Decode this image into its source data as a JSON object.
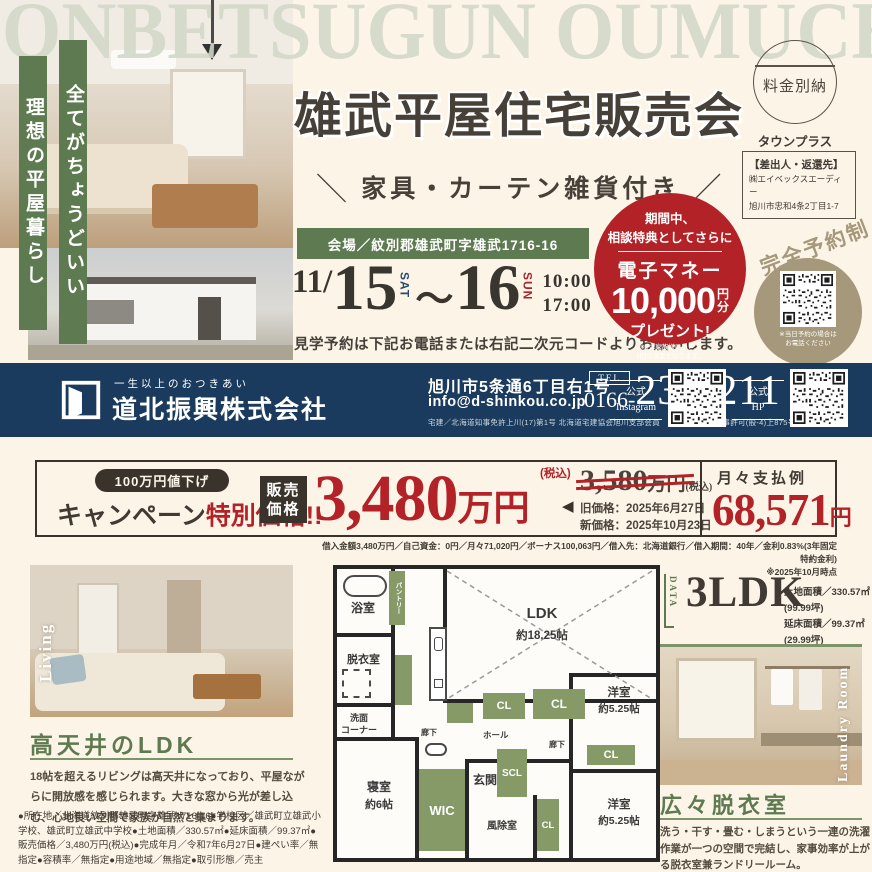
{
  "watermark": "ONBETSUGUN OUMUCHO",
  "top": {
    "banner_left": "理想の平屋暮らし",
    "banner_right": "全てがちょうどいい",
    "title": "雄武平屋住宅販売会",
    "subtitle_left_slash": "＼",
    "subtitle": "家具・カーテン雑貨付き",
    "subtitle_right_slash": "／",
    "postal_stamp": "料金別納",
    "postal_service": "タウンプラス",
    "sender_heading": "【差出人・返還先】",
    "sender_name": "㈱エイベックスエーディー",
    "sender_address": "旭川市忠和4条2丁目1-7",
    "venue": "会場／紋別郡雄武町字雄武1716-16",
    "date_month": "11/",
    "date_day1": "15",
    "date_day1_dow": "SAT",
    "date_tilde": "～",
    "date_day2": "16",
    "date_day2_dow": "SUN",
    "time_line1": "10:00 -",
    "time_line2": "17:00",
    "booking_note": "見学予約は下記お電話または右記二次元コードよりお願いします。",
    "bonus": {
      "line1": "期間中、",
      "line2": "相談特典としてさらに",
      "product": "電子マネー",
      "amount": "10,000",
      "unit_l1": "円",
      "unit_l2": "分",
      "present": "プレゼント!",
      "note1": "※お1家族様につき、",
      "note2": "1回の進呈となります。"
    },
    "reserve_badge": "完全予約制",
    "qr_note1": "※当日予約の場合は",
    "qr_note2": "お電話ください"
  },
  "company": {
    "tagline": "一生以上のおつきあい",
    "name": "道北振興株式会社",
    "address": "旭川市5条通6丁目右1号",
    "email": "info@d-shinkou.co.jp",
    "tel_label": "TEL",
    "tel_area": "0166-",
    "tel_number": "23-0211",
    "license": "宅建／北海道知事免許上川(17)第1号 北海道宅建協会旭川支部会員　建設／北海道知事許可(般-4)上875号",
    "sns_instagram_l1": "公式",
    "sns_instagram_l2": "Instagram",
    "sns_hp_l1": "公式",
    "sns_hp_l2": "HP"
  },
  "campaign": {
    "discount_badge": "100万円値下げ",
    "heading_black": "キャンペーン",
    "heading_red": "特別価格!!",
    "price_label_l1": "販売",
    "price_label_l2": "価格",
    "price": "3,480",
    "price_unit": "万円",
    "price_tax": "(税込)",
    "arrow": "◀",
    "old_price": "3,580",
    "old_unit": "万円",
    "old_tax": "(税込)",
    "old_date": "旧価格：2025年6月27日",
    "new_date": "新価格：2025年10月23日",
    "monthly_label": "月々支払例",
    "monthly_amount": "68,571",
    "monthly_unit": "円",
    "loan_note": "借入金額3,480万円／自己資金：0円／月々71,020円／ボーナス100,063円／借入先：北海道銀行／借入期間：40年／金利0.83%(3年固定特約金利)",
    "loan_asof": "※2025年10月時点"
  },
  "living": {
    "photo_tag": "Living",
    "heading": "高天井のLDK",
    "body": "18帖を超えるリビングは高天井になっており、平屋ながらに開放感を感じられます。大きな窓から光が差し込む、心地良い空間で家族が自然と集まります。",
    "footnote": "●所在地／北海道紋別郡雄武町字雄武1716-16●学校区／雄武町立雄武小学校、雄武町立雄武中学校●土地面積／330.57㎡●延床面積／99.37㎡●販売価格／3,480万円(税込)●完成年月／令和7年6月27日●建ぺい率／無指定●容積率／無指定●用途地域／無指定●取引形態／売主"
  },
  "plan": {
    "data_label": "DATA",
    "layout": "3LDK",
    "land_area": "土地面積／330.57㎡(99.99坪)",
    "floor_area": "延床面積／99.37㎡(29.99坪)",
    "rooms": {
      "ldk": "LDK",
      "ldk_size": "約18.25帖",
      "bath": "浴室",
      "pantry": "パントリー",
      "dressing": "脱衣室",
      "wash_l1": "洗面",
      "wash_l2": "コーナー",
      "hallway": "廊下",
      "hall": "ホール",
      "entrance": "玄関",
      "scl": "SCL",
      "cl": "CL",
      "wic": "WIC",
      "windbreak": "風除室",
      "bedroom": "寝室",
      "bedroom_size": "約6帖",
      "western": "洋室",
      "western_size": "約5.25帖"
    }
  },
  "laundry": {
    "photo_tag": "Laundry Room",
    "heading": "広々脱衣室",
    "body": "洗う・干す・畳む・しまうという一連の洗濯作業が一つの空間で完結し、家事効率が上がる脱衣室兼ランドリールーム。"
  },
  "colors": {
    "cream": "#fcf4e7",
    "green": "#5d7a50",
    "navy": "#1b3b5e",
    "red": "#b22227",
    "gold": "#a6987a",
    "plan_green": "#869a68",
    "watermark_sage": "#d0d7c7"
  }
}
